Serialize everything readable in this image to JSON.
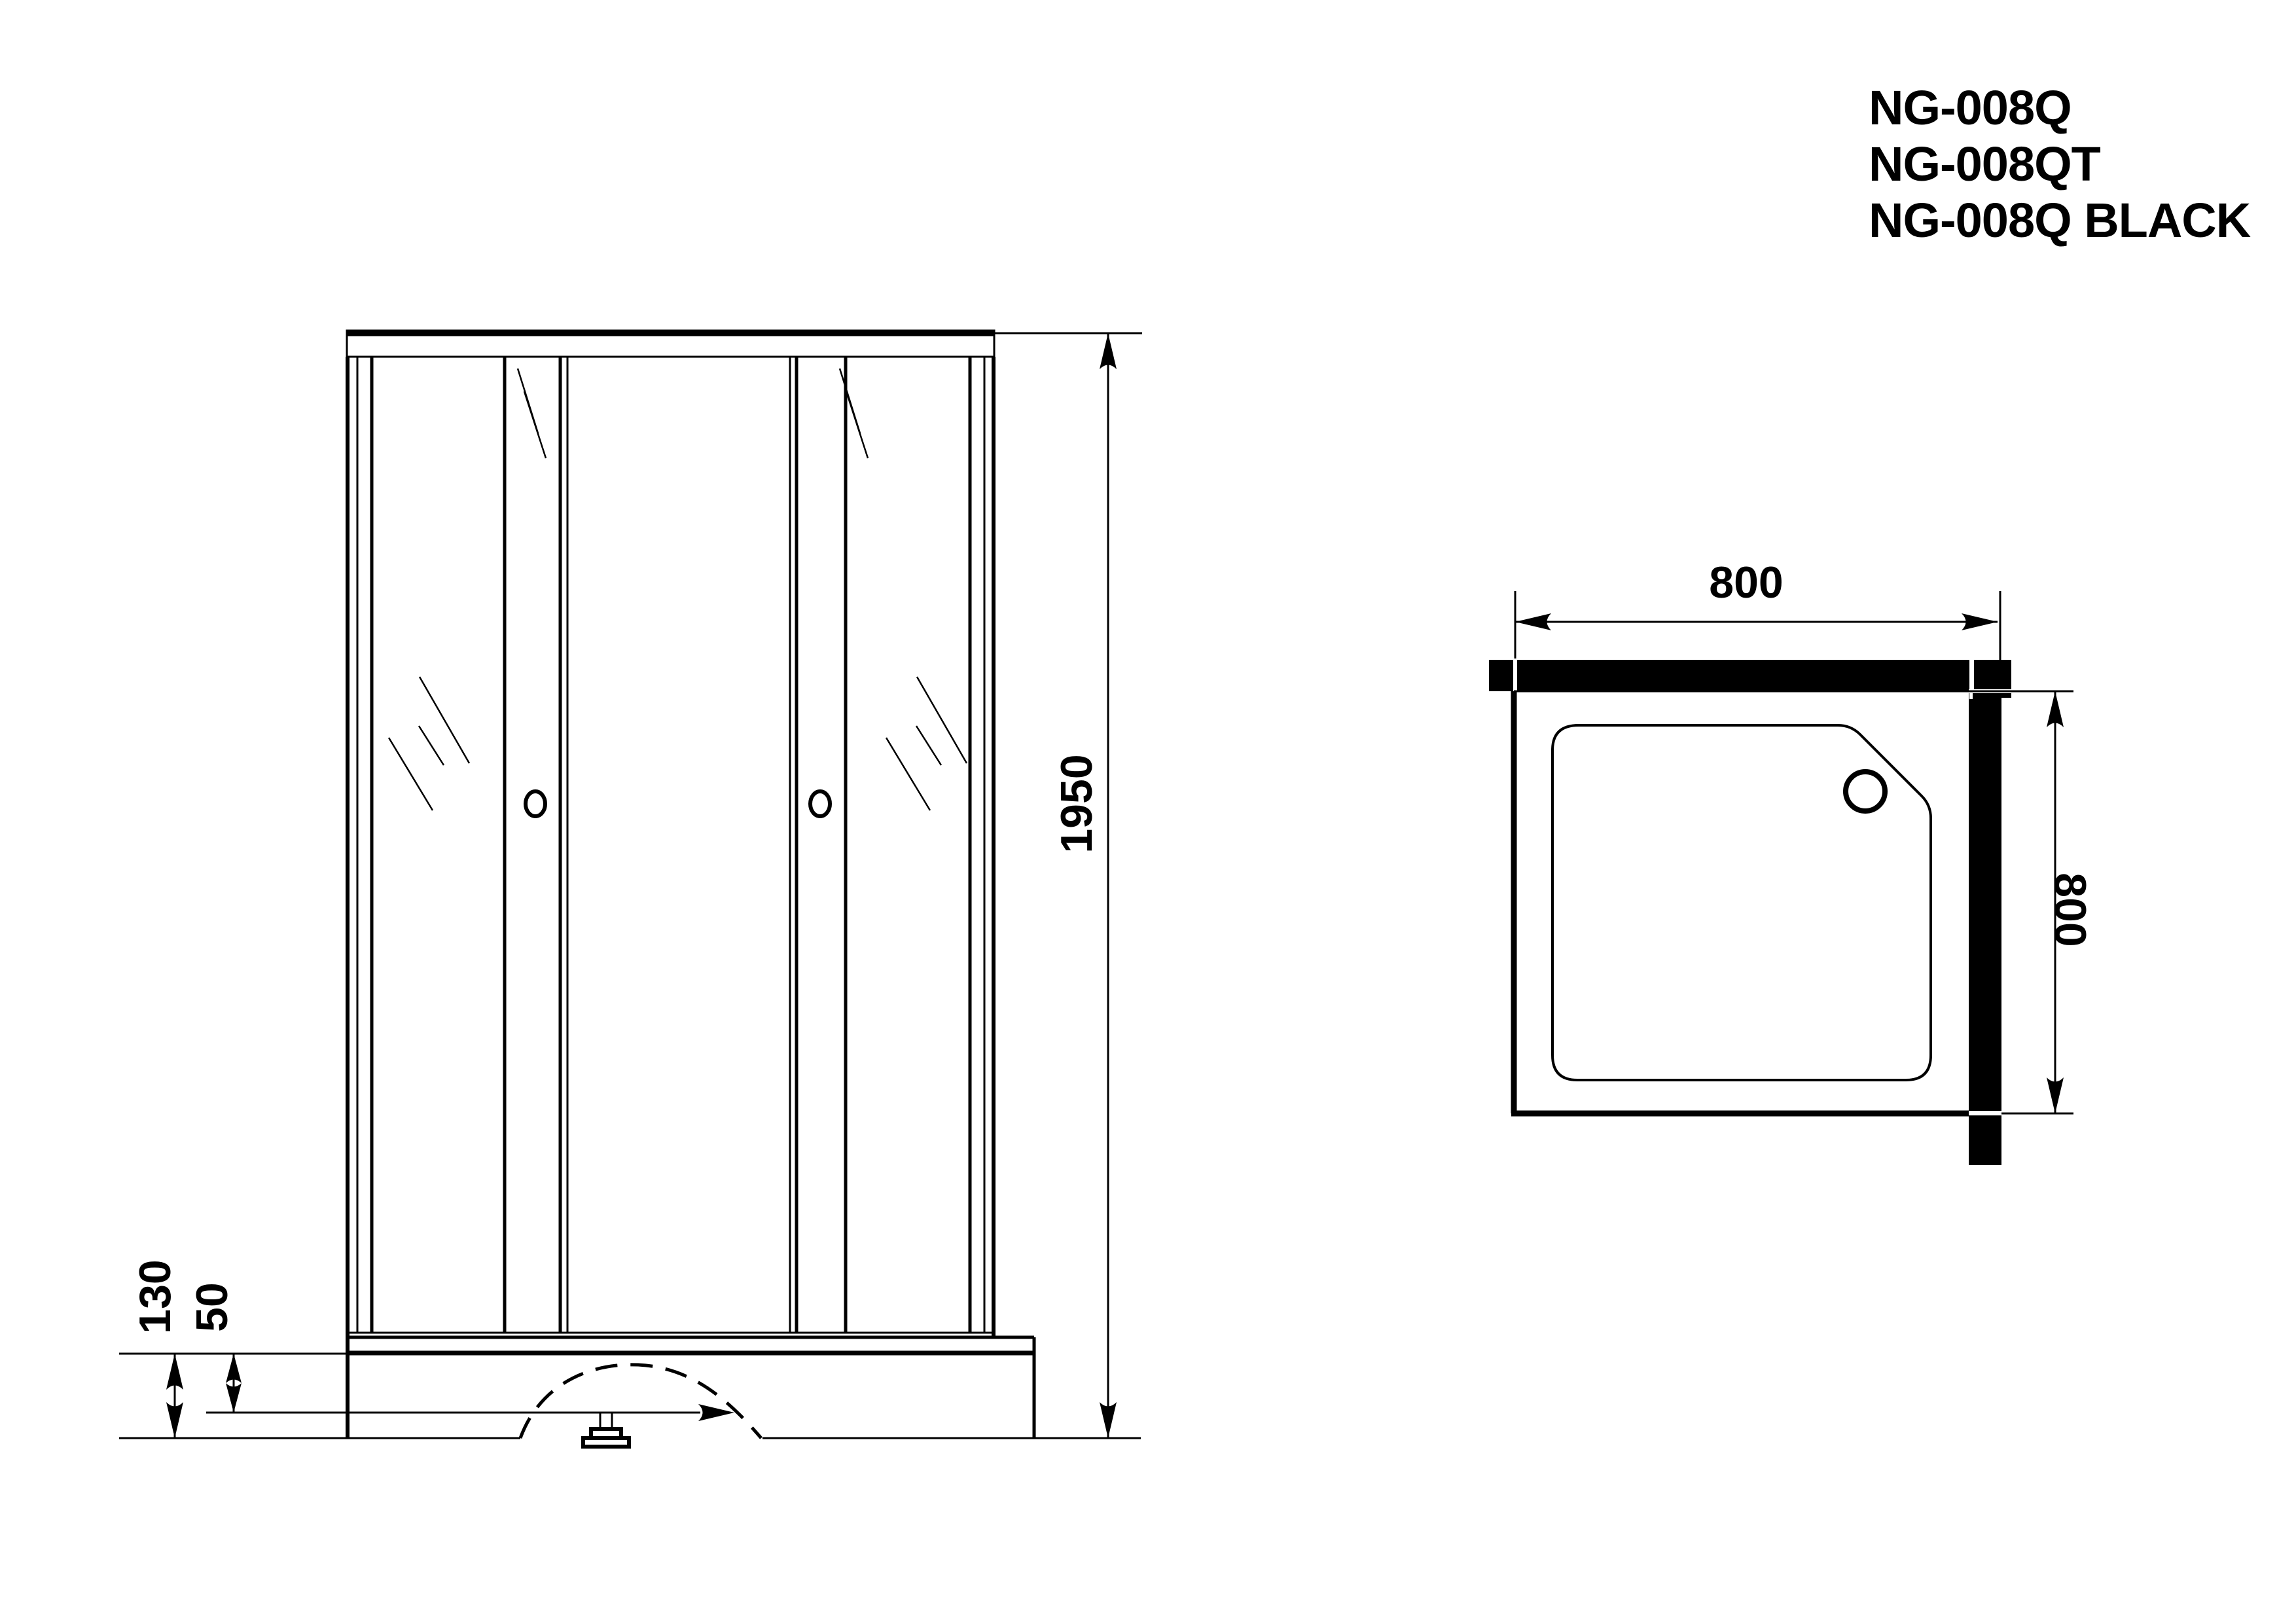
{
  "title_block": {
    "models": [
      "NG-008Q",
      "NG-008QT",
      "NG-008Q BLACK"
    ]
  },
  "front_view": {
    "overall_height_mm": "1950",
    "tray_height_mm": "130",
    "tray_inner_height_mm": "50"
  },
  "plan_view": {
    "width_mm": "800",
    "depth_mm": "800"
  },
  "colors": {
    "ink": "#000000",
    "background": "#ffffff"
  }
}
